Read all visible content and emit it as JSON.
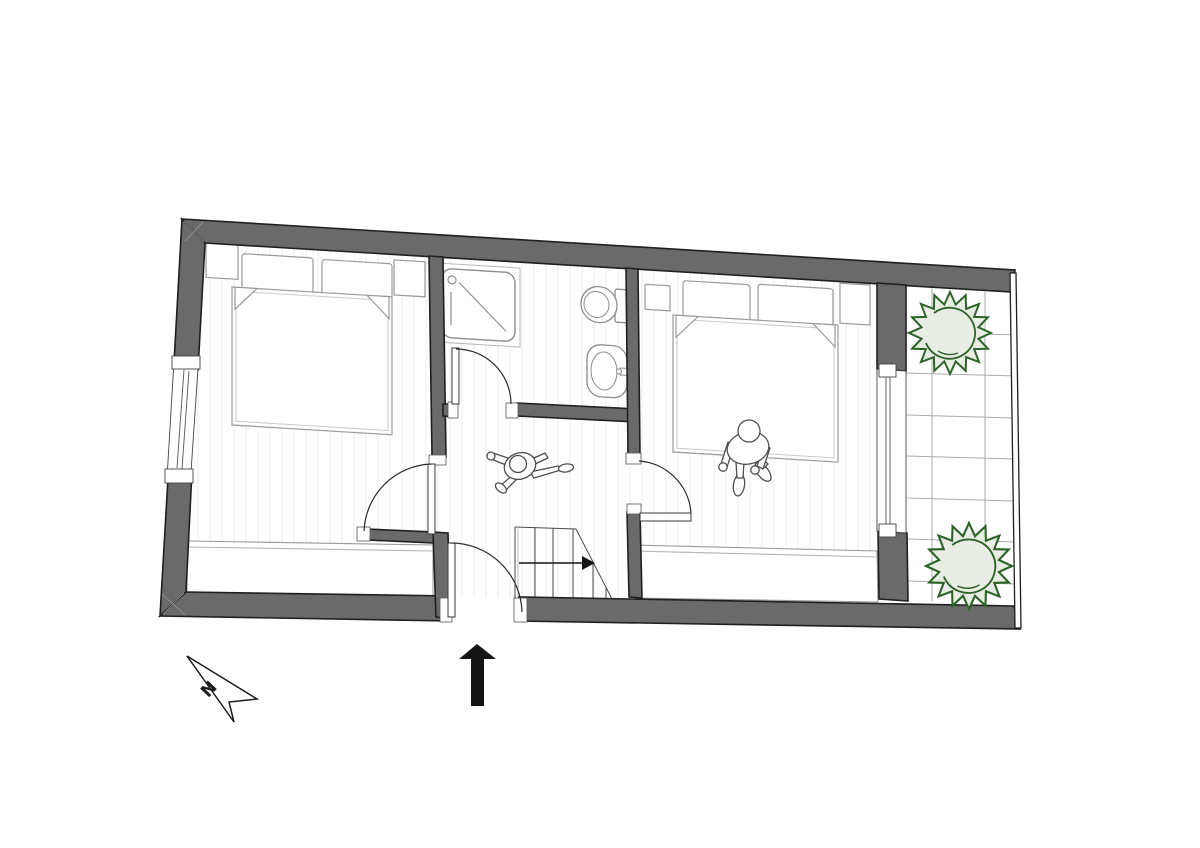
{
  "title": "Apartment upper-storey floor plan",
  "north_indicator": {
    "label": "N"
  },
  "palette": {
    "wall_fill": "#6a6a6a",
    "wall_outline": "#1f1f1f",
    "floor": "#ffffff",
    "floor_stripe": "#ececec",
    "fixture_line": "#9a9a9a",
    "detail_line": "#4a4a4a",
    "tile_line": "#ababab",
    "plant_stroke": "#2c6428",
    "plant_fill": "#e9ece4",
    "solid_black": "#141414"
  },
  "rooms": [
    {
      "name": "bedroom-left",
      "contents": [
        "double bed",
        "two pillows",
        "two nightstands",
        "built-in wardrobe"
      ]
    },
    {
      "name": "bathroom",
      "contents": [
        "shower tray",
        "toilet",
        "washbasin"
      ]
    },
    {
      "name": "hall-landing",
      "contents": [
        "staircase",
        "stair direction arrow",
        "walking person figure"
      ]
    },
    {
      "name": "bedroom-right",
      "contents": [
        "double bed",
        "two pillows",
        "two nightstands",
        "built-in wardrobe",
        "person sitting on bed"
      ]
    },
    {
      "name": "balcony",
      "contents": [
        "tiled floor",
        "two plants",
        "railing"
      ]
    }
  ],
  "doors": [
    "entrance door",
    "bathroom door",
    "left bedroom door",
    "right bedroom door",
    "balcony glazed door"
  ],
  "windows": [
    "left wall window"
  ],
  "annotations": {
    "entry_arrow": "solid black arrow pointing up at the entrance opening",
    "stair_arrow": "direction arrow on staircase pointing right"
  }
}
